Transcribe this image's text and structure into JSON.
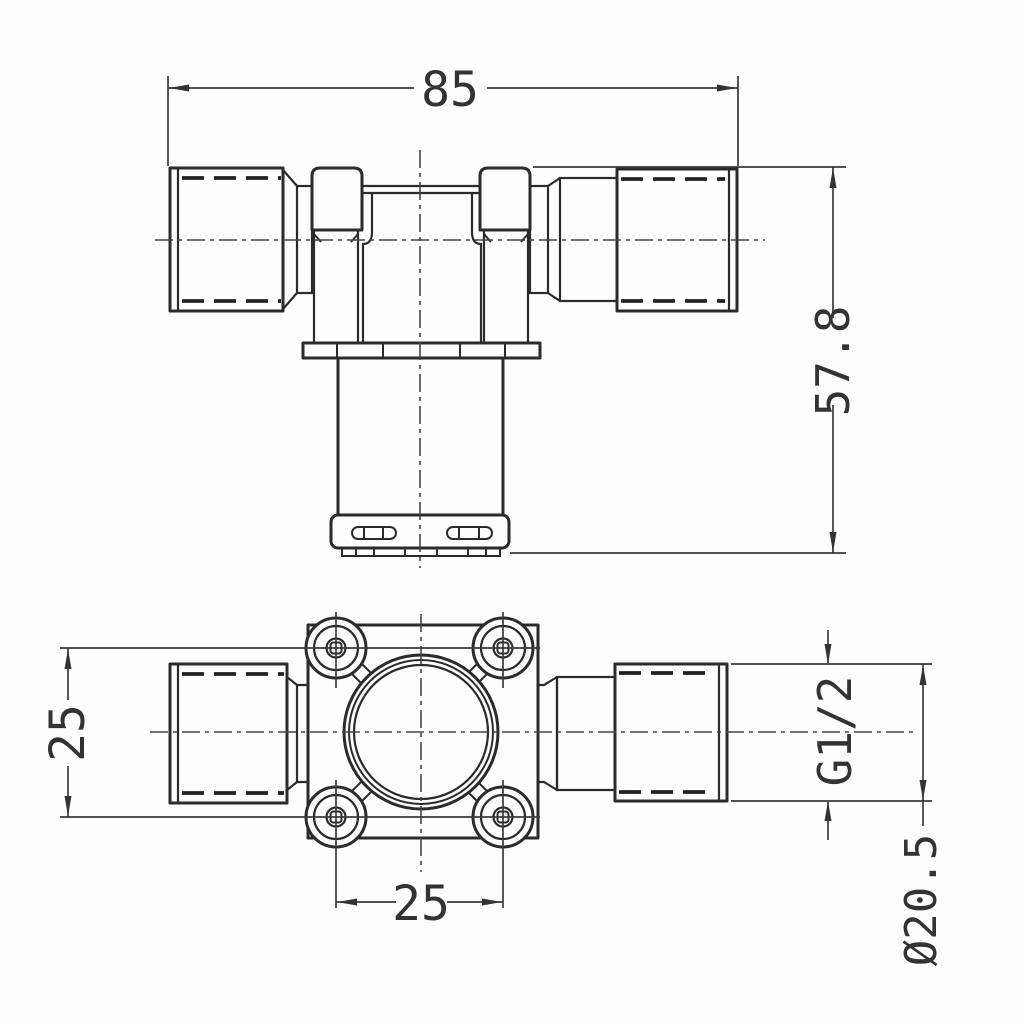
{
  "drawing": {
    "part_name": "solenoid-valve-dimension-drawing",
    "colors": {
      "line": "#2b2b2b",
      "dimension": "#3a3a3a",
      "background": "#fdfdfd"
    },
    "front_view": {
      "overall_length": "85",
      "overall_height": "57.8"
    },
    "top_view": {
      "mount_hole_spacing_vertical": "25",
      "mount_hole_spacing_horizontal": "25",
      "inlet_thread": "G1/2",
      "thread_outer_diameter": "Ø20.5"
    }
  }
}
